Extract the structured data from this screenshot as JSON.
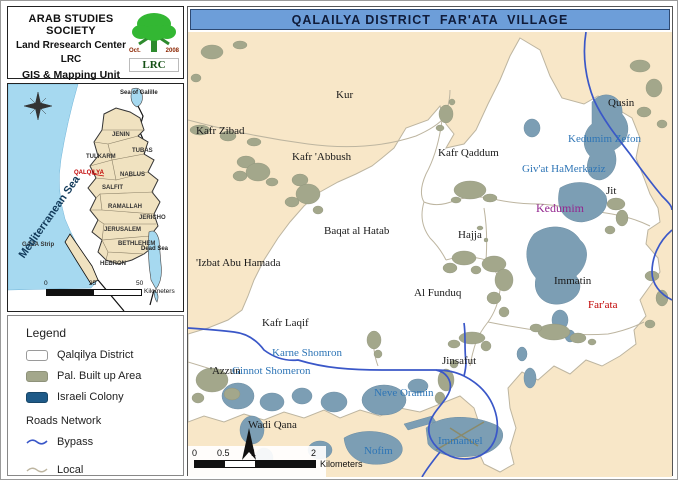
{
  "header": {
    "org": "ARAB STUDIES SOCIETY",
    "center": "Land Rresearch Center",
    "abbr": "LRC",
    "unit": "GIS & Mapping Unit",
    "logo": {
      "month": "Oct.",
      "year": "2008",
      "abbr": "LRC"
    }
  },
  "title_bar": {
    "title": "QALAILYA DISTRICT  FAR'ATA  VILLAGE"
  },
  "inset": {
    "labels": [
      {
        "text": "Sea of Galille",
        "x": 112,
        "y": 6,
        "cls": "water"
      },
      {
        "text": "JENIN",
        "x": 104,
        "y": 48,
        "cls": ""
      },
      {
        "text": "TUBAS",
        "x": 124,
        "y": 64,
        "cls": ""
      },
      {
        "text": "TULKARM",
        "x": 78,
        "y": 70,
        "cls": ""
      },
      {
        "text": "QALQILYA",
        "x": 66,
        "y": 86,
        "cls": "red"
      },
      {
        "text": "NABLUS",
        "x": 112,
        "y": 88,
        "cls": ""
      },
      {
        "text": "SALFIT",
        "x": 94,
        "y": 101,
        "cls": ""
      },
      {
        "text": "RAMALLAH",
        "x": 100,
        "y": 120,
        "cls": ""
      },
      {
        "text": "JERICHO",
        "x": 131,
        "y": 131,
        "cls": ""
      },
      {
        "text": "JERUSALEM",
        "x": 96,
        "y": 143,
        "cls": ""
      },
      {
        "text": "BETHLEHEM",
        "x": 110,
        "y": 157,
        "cls": ""
      },
      {
        "text": "HEBRON",
        "x": 92,
        "y": 177,
        "cls": ""
      },
      {
        "text": "Dead Sea",
        "x": 133,
        "y": 162,
        "cls": "water"
      },
      {
        "text": "GAZA Strip",
        "x": 14,
        "y": 158,
        "cls": ""
      },
      {
        "text": "Mediterranean Sea",
        "x": 14,
        "y": 168,
        "cls": "sea",
        "rotate": -55
      }
    ],
    "scale": {
      "ticks": [
        "0",
        "25",
        "50"
      ],
      "unit": "Kilometers"
    }
  },
  "legend": {
    "title": "Legend",
    "items": [
      {
        "swatch": "district",
        "label": "Qalqilya District"
      },
      {
        "swatch": "builtup",
        "label": "Pal. Built up Area"
      },
      {
        "swatch": "colony",
        "label": "Israeli Colony"
      }
    ],
    "roads_title": "Roads Network",
    "road_items": [
      {
        "type": "bypass",
        "label": "Bypass"
      },
      {
        "type": "local",
        "label": "Local"
      }
    ]
  },
  "main_map": {
    "labels": [
      {
        "text": "Kur",
        "x": 148,
        "y": 58,
        "cls": "v"
      },
      {
        "text": "Kafr Zibad",
        "x": 8,
        "y": 94,
        "cls": "v"
      },
      {
        "text": "Kafr 'Abbush",
        "x": 104,
        "y": 120,
        "cls": "v"
      },
      {
        "text": "Kafr Qaddum",
        "x": 250,
        "y": 116,
        "cls": "v"
      },
      {
        "text": "Qusin",
        "x": 420,
        "y": 66,
        "cls": "v"
      },
      {
        "text": "Kedumim Zefon",
        "x": 380,
        "y": 102,
        "cls": "c"
      },
      {
        "text": "Giv'at HaMerkaziz",
        "x": 334,
        "y": 132,
        "cls": "c"
      },
      {
        "text": "Jit",
        "x": 418,
        "y": 154,
        "cls": "v"
      },
      {
        "text": "Kedumim",
        "x": 348,
        "y": 170,
        "cls": "major"
      },
      {
        "text": "Baqat al Hatab",
        "x": 136,
        "y": 194,
        "cls": "v"
      },
      {
        "text": "Hajja",
        "x": 270,
        "y": 198,
        "cls": "v"
      },
      {
        "text": "'Izbat Abu Hamada",
        "x": 8,
        "y": 226,
        "cls": "v"
      },
      {
        "text": "Al Funduq",
        "x": 226,
        "y": 256,
        "cls": "v"
      },
      {
        "text": "Immatin",
        "x": 366,
        "y": 244,
        "cls": "v"
      },
      {
        "text": "Far'ata",
        "x": 400,
        "y": 268,
        "cls": "subject"
      },
      {
        "text": "Kafr Laqif",
        "x": 74,
        "y": 286,
        "cls": "v"
      },
      {
        "text": "Karne Shomron",
        "x": 84,
        "y": 316,
        "cls": "c"
      },
      {
        "text": "'Azzun",
        "x": 22,
        "y": 334,
        "cls": "v"
      },
      {
        "text": "Ginnot Shomeron",
        "x": 44,
        "y": 334,
        "cls": "c"
      },
      {
        "text": "Neve Oramin",
        "x": 186,
        "y": 356,
        "cls": "c"
      },
      {
        "text": "Wadi Qana",
        "x": 60,
        "y": 388,
        "cls": "v"
      },
      {
        "text": "Nofim",
        "x": 176,
        "y": 414,
        "cls": "c"
      },
      {
        "text": "Jinsafut",
        "x": 254,
        "y": 324,
        "cls": "v"
      },
      {
        "text": "Immanuel",
        "x": 250,
        "y": 404,
        "cls": "c"
      }
    ],
    "scale": {
      "ticks": [
        "0",
        "0.5",
        "1",
        "2"
      ],
      "unit": "Kilometers"
    }
  },
  "colors": {
    "title_bar_bg": "#6D9ED9",
    "map_outside": "#F8E7C8",
    "district_fill": "#FFFFFF",
    "district_border": "#BDB5A0",
    "pal_builtup": "#A3A78B",
    "israeli_colony_fill": "#7C9EB4",
    "israeli_colony_legend": "#1E5A88",
    "bypass_road": "#3A57C8",
    "local_road": "#BDB5A0",
    "colony_label": "#2E75B6",
    "subject_label": "#C00000",
    "major_colony_label": "#93268F",
    "inset_sea": "#A6D9F0",
    "inset_land": "#F0E2C0"
  }
}
